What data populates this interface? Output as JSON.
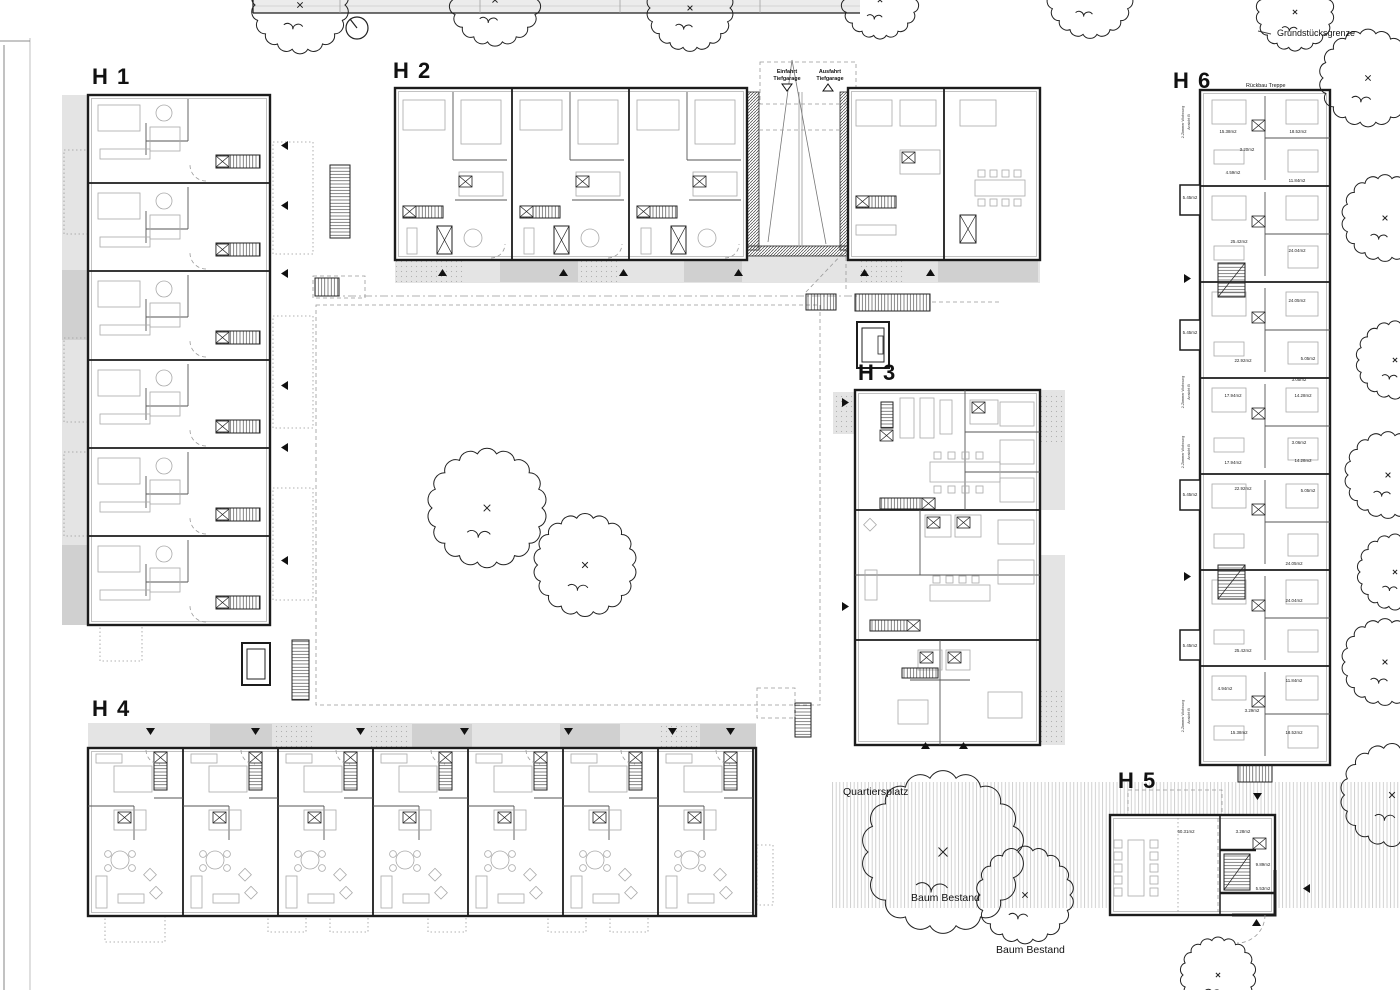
{
  "colors": {
    "paper": "#ffffff",
    "ink": "#1c1c1c",
    "light_gray": "#e4e4e4",
    "mid_gray": "#d0d0d0",
    "furniture_gray": "#a9a9a9",
    "dash_gray": "#999999"
  },
  "buildings": [
    {
      "label": "H 1"
    },
    {
      "label": "H 2"
    },
    {
      "label": "H 3"
    },
    {
      "label": "H 4"
    },
    {
      "label": "H 5"
    },
    {
      "label": "H 6"
    }
  ],
  "site": {
    "property_boundary": "Grundstücksgrenze",
    "plaza": "Quartiersplatz",
    "existing_trees": [
      "Baum Bestand",
      "Baum Bestand"
    ]
  },
  "garage": {
    "entry": {
      "line1": "Einfahrt",
      "line2": "Tiefgarage"
    },
    "exit": {
      "line1": "Ausfahrt",
      "line2": "Tiefgarage"
    }
  },
  "h6": {
    "note": "Rückbau Treppe",
    "rooms": [
      {
        "x": 1228,
        "y": 133,
        "t": "15.38m2"
      },
      {
        "x": 1298,
        "y": 133,
        "t": "18.52m2"
      },
      {
        "x": 1247,
        "y": 151,
        "t": "3.20m2"
      },
      {
        "x": 1233,
        "y": 174,
        "t": "4.59m2"
      },
      {
        "x": 1297,
        "y": 182,
        "t": "11.84m2"
      },
      {
        "x": 1190,
        "y": 199,
        "t": "5.45m2"
      },
      {
        "x": 1239,
        "y": 243,
        "t": "25.42m2"
      },
      {
        "x": 1297,
        "y": 252,
        "t": "24.04m2"
      },
      {
        "x": 1297,
        "y": 302,
        "t": "24.05m2"
      },
      {
        "x": 1190,
        "y": 334,
        "t": "5.45m2"
      },
      {
        "x": 1243,
        "y": 362,
        "t": "22.92m2"
      },
      {
        "x": 1308,
        "y": 360,
        "t": "5.05m2"
      },
      {
        "x": 1299,
        "y": 381,
        "t": "3.05m2"
      },
      {
        "x": 1233,
        "y": 397,
        "t": "17.94m2"
      },
      {
        "x": 1303,
        "y": 397,
        "t": "14.28m2"
      },
      {
        "x": 1299,
        "y": 444,
        "t": "3.06m2"
      },
      {
        "x": 1233,
        "y": 464,
        "t": "17.94m2"
      },
      {
        "x": 1303,
        "y": 462,
        "t": "14.28m2"
      },
      {
        "x": 1243,
        "y": 490,
        "t": "22.92m2"
      },
      {
        "x": 1308,
        "y": 492,
        "t": "5.05m2"
      },
      {
        "x": 1190,
        "y": 496,
        "t": "5.45m2"
      },
      {
        "x": 1294,
        "y": 565,
        "t": "24.05m2"
      },
      {
        "x": 1294,
        "y": 602,
        "t": "24.04m2"
      },
      {
        "x": 1190,
        "y": 647,
        "t": "5.45m2"
      },
      {
        "x": 1243,
        "y": 652,
        "t": "25.42m2"
      },
      {
        "x": 1294,
        "y": 682,
        "t": "11.84m2"
      },
      {
        "x": 1225,
        "y": 690,
        "t": "4.94m2"
      },
      {
        "x": 1252,
        "y": 712,
        "t": "3.29m2"
      },
      {
        "x": 1239,
        "y": 734,
        "t": "15.38m2"
      },
      {
        "x": 1294,
        "y": 734,
        "t": "18.52m2"
      }
    ],
    "side_notes": [
      {
        "x": 1184,
        "y": 122,
        "r": -90,
        "t": "2-Zimmer Wohnung"
      },
      {
        "x": 1190,
        "y": 122,
        "r": -90,
        "t": "Ansicht B"
      },
      {
        "x": 1184,
        "y": 392,
        "r": -90,
        "t": "2-Zimmer Wohnung"
      },
      {
        "x": 1190,
        "y": 392,
        "r": -90,
        "t": "Ansicht B"
      },
      {
        "x": 1184,
        "y": 452,
        "r": -90,
        "t": "2-Zimmer Wohnung"
      },
      {
        "x": 1190,
        "y": 452,
        "r": -90,
        "t": "Ansicht B"
      },
      {
        "x": 1184,
        "y": 716,
        "r": -90,
        "t": "2-Zimmer Wohnung"
      },
      {
        "x": 1190,
        "y": 716,
        "r": -90,
        "t": "Ansicht B"
      }
    ]
  },
  "h5": {
    "rooms": [
      {
        "x": 1186,
        "y": 833,
        "t": "60.31m2"
      },
      {
        "x": 1243,
        "y": 833,
        "t": "3.28m2"
      },
      {
        "x": 1263,
        "y": 866,
        "t": "9.89m2"
      },
      {
        "x": 1263,
        "y": 890,
        "t": "5.53m2"
      }
    ]
  }
}
